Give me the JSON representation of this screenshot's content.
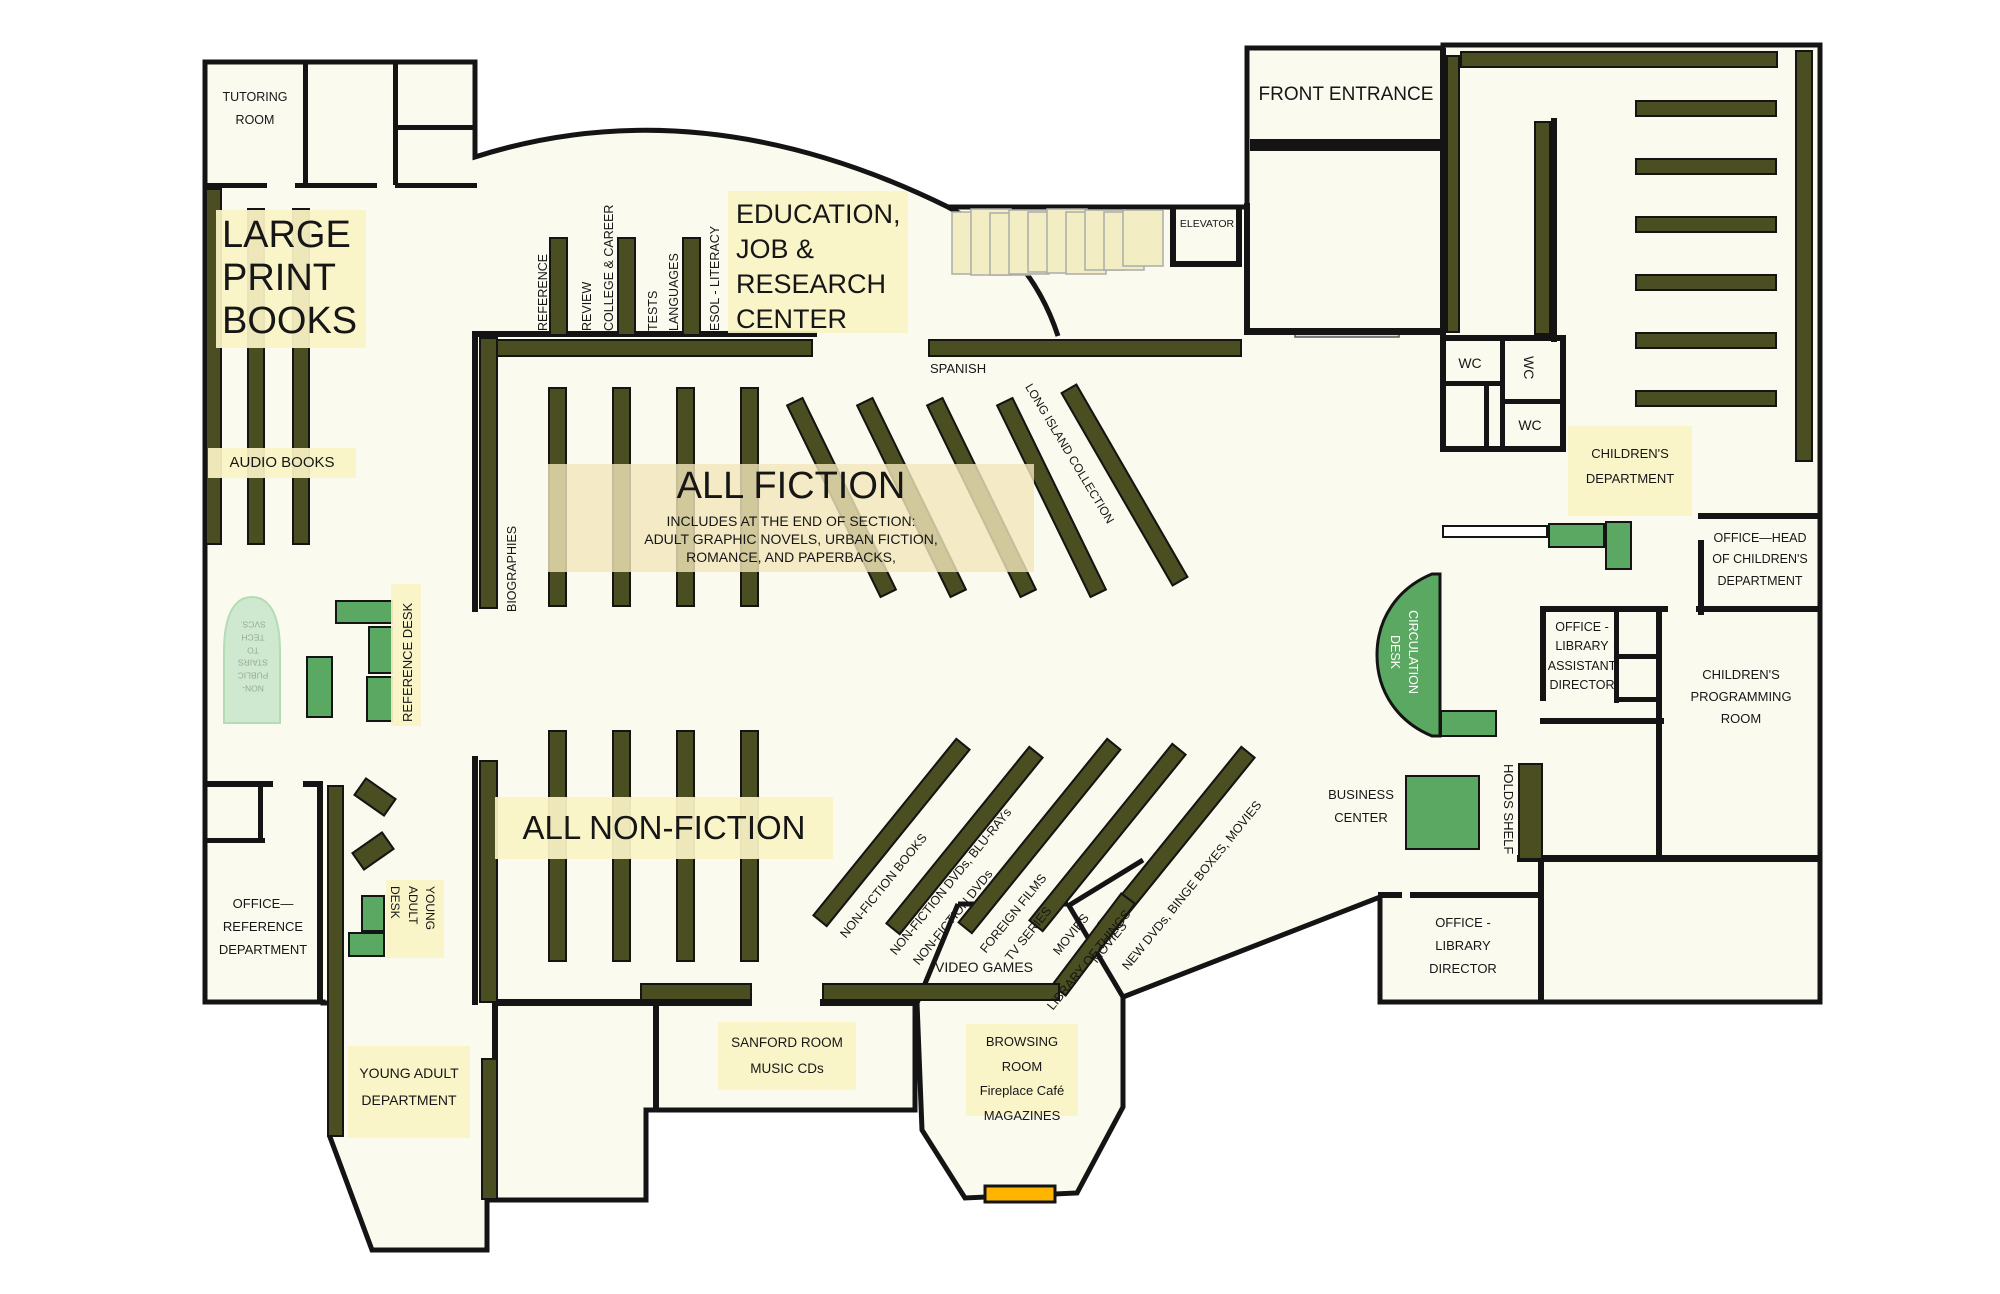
{
  "plan": {
    "rooms": {
      "tutoring_room": "TUTORING\nROOM",
      "front_entrance": "FRONT ENTRANCE",
      "elevator": "ELEVATOR",
      "wc1": "WC",
      "wc2": "WC",
      "wc3": "WC",
      "office_reference": "OFFICE—\nREFERENCE\nDEPARTMENT",
      "young_adult_department": "YOUNG ADULT\nDEPARTMENT",
      "sanford_room": "SANFORD ROOM\nMUSIC CDs",
      "browsing_room": "BROWSING ROOM\nFireplace Café\nMAGAZINES",
      "office_library_director": "OFFICE -\nLIBRARY\nDIRECTOR",
      "office_library_assistant_director": "OFFICE -\nLIBRARY\nASSISTANT\nDIRECTOR",
      "office_head_childrens": "OFFICE—HEAD\nOF CHILDREN'S\nDEPARTMENT",
      "childrens_programming_room": "CHILDREN'S\nPROGRAMMING\nROOM",
      "childrens_department": "CHILDREN'S\nDEPARTMENT"
    },
    "areas": {
      "large_print_books": "LARGE\nPRINT\nBOOKS",
      "audio_books": "AUDIO BOOKS",
      "education_center": "EDUCATION,\nJOB &\nRESEARCH\nCENTER",
      "all_fiction_title": "ALL FICTION",
      "all_fiction_note": "INCLUDES AT THE END OF SECTION:\nADULT GRAPHIC NOVELS, URBAN FICTION,\nROMANCE,  AND PAPERBACKS,",
      "all_nonfiction": "ALL NON-FICTION",
      "spanish": "SPANISH",
      "long_island_collection": "LONG ISLAND COLLECTION",
      "biographies": "BIOGRAPHIES",
      "video_games": "VIDEO GAMES",
      "young_adult_desk": "YOUNG\nADULT\nDESK",
      "reference_desk": "REFERENCE DESK",
      "circulation_desk": "CIRCULATION\nDESK",
      "business_center": "BUSINESS\nCENTER",
      "holds_shelf": "HOLDS SHELF",
      "stairs_note": "NON-\nPUBLIC\nSTAIRS\nTO\nTECH\nSVCS."
    },
    "education_shelves": [
      "REFERENCE",
      "REVIEW",
      "COLLEGE & CAREER",
      "TESTS",
      "LANGUAGES",
      "ESOL - LITERACY"
    ],
    "av_shelves": [
      "NON-FICTION BOOKS",
      "NON-FICTION DVDs, BLU-RAYs",
      "NON-FICTION DVDs",
      "FOREIGN FILMS",
      "TV SERIES",
      "MOVIES",
      "MOVIES",
      "NEW DVDs, BINGE BOXES, MOVIES",
      "LIBRARY OF THINGS"
    ],
    "colors": {
      "wall": "#141414",
      "floor": "#FBFAEE",
      "shelf_olive": "#4A4E21",
      "desk_green": "#5BA863",
      "label_yellow": "#FAF3C6",
      "fireplace_orange": "#FFB400",
      "stairs_green": "#CEE9CF"
    }
  }
}
